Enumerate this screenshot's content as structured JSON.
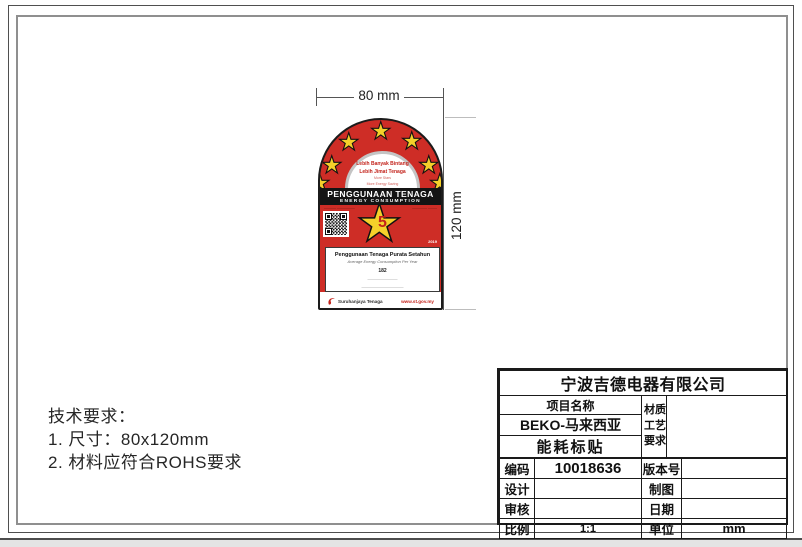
{
  "colors": {
    "label_red": "#CE2D26",
    "star_yellow": "#F5D02A",
    "banner_black": "#141414",
    "accent_red": "#C3231B"
  },
  "icons": {
    "star": "★"
  },
  "dimensions": {
    "width_label": "80 mm",
    "height_label": "120 mm"
  },
  "tech_requirements": {
    "title": "技术要求：",
    "item1": "1. 尺寸：80x120mm",
    "item2": "2. 材料应符合ROHS要求"
  },
  "energy_label": {
    "arch": {
      "line1": "Lebih Banyak Bintang",
      "line2": "Lebih Jimat Tenaga",
      "line3": "More Stars",
      "line4": "More Energy Saving"
    },
    "banner": {
      "title": "PENGGUNAAN TENAGA",
      "subtitle": "ENERGY CONSUMPTION"
    },
    "mid": {
      "micro_left": "———— ——————",
      "micro_right": "————— ———",
      "rating": "5",
      "year": "2019"
    },
    "panel": {
      "title_my": "Penggunaan Tenaga Purata Setahun",
      "title_en": "Average Energy Consumption Per Year",
      "value": "182",
      "micro1": "——————————",
      "micro2": "——————————————",
      "micro3": "————————————————",
      "micro4": "——————————————",
      "micro5": "———————————"
    },
    "footer": {
      "brand": "Suruhanjaya Tenaga",
      "url": "www.st.gov.my"
    }
  },
  "title_block": {
    "company": "宁波吉德电器有限公司",
    "project_label": "项目名称",
    "project_name": "BEKO-马来西亚",
    "project_type": "能耗标贴",
    "material_l1": "材质",
    "material_l2": "工艺",
    "material_l3": "要求",
    "rows": [
      {
        "l": "编码",
        "v": "10018636",
        "l2": "版本号",
        "v2": ""
      },
      {
        "l": "设计",
        "v": "",
        "l2": "制图",
        "v2": ""
      },
      {
        "l": "审核",
        "v": "",
        "l2": "日期",
        "v2": ""
      },
      {
        "l": "比例",
        "v": "1:1",
        "l2": "单位",
        "v2": "mm"
      }
    ]
  }
}
